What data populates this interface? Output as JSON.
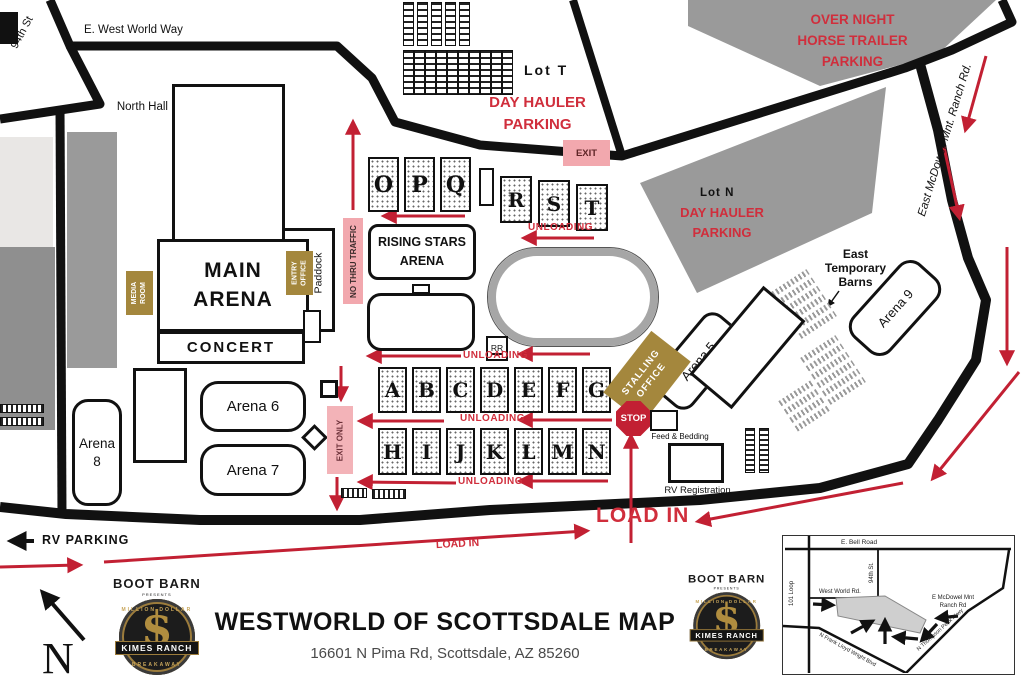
{
  "colors": {
    "accent_red": "#d02e3c",
    "arrow_red": "#c22033",
    "pink": "#f2a8ae",
    "gold": "#a4873d",
    "area_gray": "#9a9a9a"
  },
  "streets": {
    "west_world_way": "E. West World Way",
    "st_94": "94th St",
    "mcdowell": "East McDowell Mnt. Ranch Rd."
  },
  "labels": {
    "north_hall": "North Hall",
    "main_arena": "MAIN\nARENA",
    "concert": "CONCERT",
    "media_room": "MEDIA\nROOM",
    "entry_office": "ENTRY\nOFFICE",
    "paddock": "Paddock",
    "no_thru_traffic": "NO THRU TRAFFIC",
    "rising_stars": "RISING STARS\nARENA",
    "lot_t": "Lot T",
    "lot_n": "Lot N",
    "day_hauler": "DAY HAULER\nPARKING",
    "overnight": "OVER NIGHT\nHORSE TRAILER\nPARKING",
    "east_temp_barns": "East\nTemporary\nBarns",
    "exit": "EXIT",
    "exit_only": "EXIT ONLY",
    "unloading": "UNLOADING",
    "stalling_office": "STALLING\nOFFICE",
    "stop": "STOP",
    "rr": "RR",
    "feed_bedding": "Feed & Bedding",
    "rv_registration": "RV Registration",
    "rv_parking": "RV PARKING",
    "load_in": "LOAD IN",
    "arena_5": "Arena 5",
    "arena_6": "Arena 6",
    "arena_7": "Arena 7",
    "arena_8": "Arena\n8",
    "arena_9": "Arena 9",
    "compass_n": "N"
  },
  "barns": {
    "opq": [
      "O",
      "P",
      "Q"
    ],
    "rst": [
      "R",
      "S",
      "T"
    ],
    "row_a_g": [
      "A",
      "B",
      "C",
      "D",
      "E",
      "F",
      "G"
    ],
    "row_h_n": [
      "H",
      "I",
      "J",
      "K",
      "L",
      "M",
      "N"
    ]
  },
  "footer": {
    "title": "WESTWORLD OF SCOTTSDALE MAP",
    "address": "16601 N Pima Rd, Scottsdale, AZ 85260",
    "logo": {
      "boot_barn": "BOOT BARN",
      "presents": "PRESENTS",
      "million_dollar": "MILLION DOLLAR",
      "kimes_ranch": "KIMES RANCH",
      "breakaway": "BREAKAWAY",
      "dollar": "$"
    }
  },
  "inset": {
    "bell_road": "E. Bell Road",
    "loop_101": "101 Loop",
    "st_94": "94th St.",
    "west_world_rd": "West World Rd.",
    "mcdowell": "E McDowel Mnt\nRanch Rd",
    "frank_lloyd": "N Frank Lloyd Wright Blvd",
    "thompson_peak": "N Thompson Peak Pkwy"
  }
}
